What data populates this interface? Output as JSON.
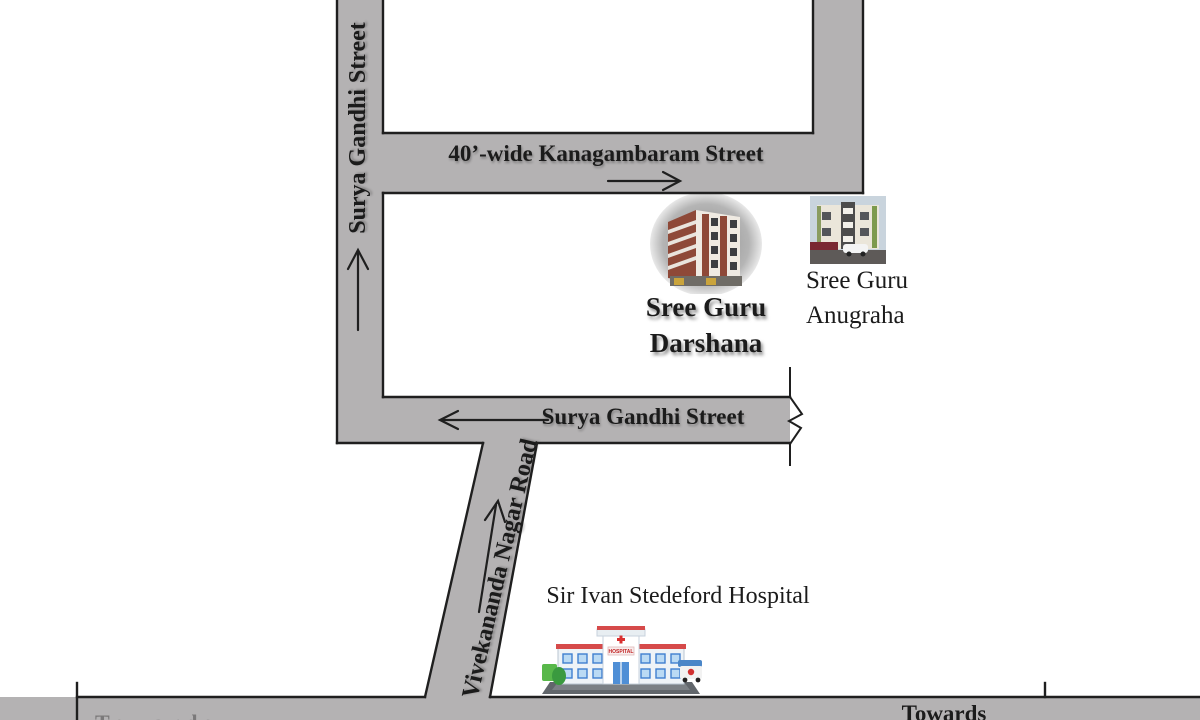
{
  "colors": {
    "road_fill": "#b4b2b3",
    "outline": "#1f1f1f",
    "ink": "#1b1b1b"
  },
  "roads": {
    "vertical_street": {
      "label": "Surya Gandhi Street"
    },
    "kanagambaram": {
      "label": "40’-wide Kanagambaram Street"
    },
    "horizontal_street": {
      "label": "Surya Gandhi Street"
    },
    "vivekananda": {
      "label": "Vivekananda Nagar Road"
    },
    "bottom_road": {
      "towards_right": "Towards",
      "towards_left_partial": "Towards"
    }
  },
  "places": {
    "darshana": {
      "line1": "Sree Guru",
      "line2": "Darshana"
    },
    "anugraha": {
      "line1": "Sree Guru",
      "line2": "Anugraha"
    },
    "hospital": {
      "label": "Sir Ivan Stedeford Hospital",
      "sign_text": "HOSPITAL"
    }
  }
}
